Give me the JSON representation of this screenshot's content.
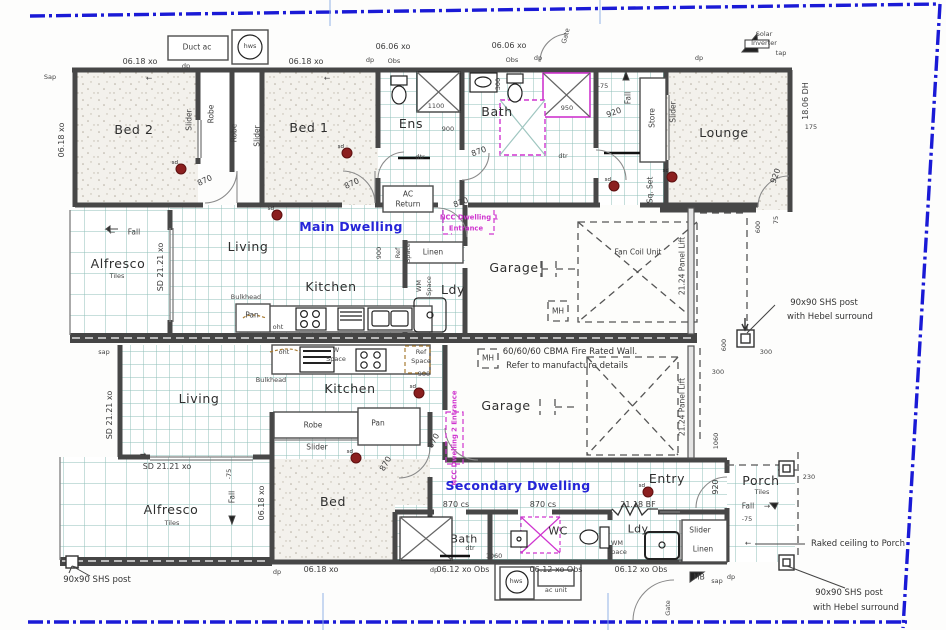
{
  "colors": {
    "boundary_blue": "#1a1ad6",
    "blue_text": "#2525d8",
    "magenta": "#cf35cf",
    "wall": "#474747",
    "tile_line": "#8fbfb8",
    "smoke_detector": "#8b1f1f",
    "hairline_blue": "#93b3e6"
  },
  "smoke_detector_label": "sd",
  "dwellings": {
    "main": "Main Dwelling",
    "secondary": "Secondary Dwelling"
  },
  "fire_wall_note": [
    "60/60/60 CBMA Fire Rated Wall.",
    "Refer to manufacture details"
  ],
  "labels": [
    {
      "n": "duct-ac",
      "t": "Duct ac",
      "x": 197,
      "y": 47,
      "r": 0,
      "c": "s"
    },
    {
      "n": "hws-top",
      "t": "hws",
      "x": 250,
      "y": 46,
      "r": 0,
      "c": "t"
    },
    {
      "n": "dim-0618-a",
      "t": "06.18 xo",
      "x": 140,
      "y": 62,
      "r": 0,
      "c": "d"
    },
    {
      "n": "dp-a",
      "t": "dp",
      "x": 186,
      "y": 66,
      "r": 0,
      "c": "t"
    },
    {
      "n": "dim-0618-b",
      "t": "06.18 xo",
      "x": 306,
      "y": 62,
      "r": 0,
      "c": "d"
    },
    {
      "n": "dim-0606-a",
      "t": "06.06 xo",
      "x": 393,
      "y": 47,
      "r": 0,
      "c": "d"
    },
    {
      "n": "dp-b",
      "t": "dp",
      "x": 370,
      "y": 60,
      "r": 0,
      "c": "t"
    },
    {
      "n": "obs-a",
      "t": "Obs",
      "x": 394,
      "y": 61,
      "r": 0,
      "c": "t"
    },
    {
      "n": "dim-0606-b",
      "t": "06.06 xo",
      "x": 509,
      "y": 46,
      "r": 0,
      "c": "d"
    },
    {
      "n": "obs-b",
      "t": "Obs",
      "x": 512,
      "y": 60,
      "r": 0,
      "c": "t"
    },
    {
      "n": "dp-c",
      "t": "dp",
      "x": 538,
      "y": 58,
      "r": 0,
      "c": "t"
    },
    {
      "n": "gate-top",
      "t": "Gate",
      "x": 566,
      "y": 36,
      "r": -75,
      "c": "t"
    },
    {
      "n": "sap-a",
      "t": "Sap",
      "x": 50,
      "y": 77,
      "r": 0,
      "c": "t"
    },
    {
      "n": "dim-0618-v",
      "t": "06.18 xo",
      "x": 62,
      "y": 140,
      "r": -90,
      "c": "d"
    },
    {
      "n": "room-bed2",
      "t": "Bed 2",
      "x": 134,
      "y": 130,
      "r": 0,
      "c": "r"
    },
    {
      "n": "slider-a",
      "t": "Slider",
      "x": 189,
      "y": 120,
      "r": -90,
      "c": "s"
    },
    {
      "n": "robe-a",
      "t": "Robe",
      "x": 211,
      "y": 114,
      "r": -90,
      "c": "s"
    },
    {
      "n": "robe-b",
      "t": "Robe",
      "x": 234,
      "y": 133,
      "r": -90,
      "c": "s"
    },
    {
      "n": "slider-b",
      "t": "Slider",
      "x": 257,
      "y": 136,
      "r": -90,
      "c": "s"
    },
    {
      "n": "room-bed1",
      "t": "Bed 1",
      "x": 309,
      "y": 128,
      "r": 0,
      "c": "r"
    },
    {
      "n": "door-870-bed2",
      "t": "870",
      "x": 205,
      "y": 181,
      "r": -25,
      "c": "d"
    },
    {
      "n": "door-870-bed1",
      "t": "870",
      "x": 352,
      "y": 184,
      "r": -25,
      "c": "d"
    },
    {
      "n": "room-ens",
      "t": "Ens",
      "x": 411,
      "y": 124,
      "r": 0,
      "c": "r"
    },
    {
      "n": "room-bath",
      "t": "Bath",
      "x": 497,
      "y": 112,
      "r": 0,
      "c": "r"
    },
    {
      "n": "dim-300-basin",
      "t": "300",
      "x": 498,
      "y": 84,
      "r": -90,
      "c": "t"
    },
    {
      "n": "dim-1100",
      "t": "1100",
      "x": 436,
      "y": 106,
      "r": 0,
      "c": "t"
    },
    {
      "n": "dim-900-ens",
      "t": "900",
      "x": 448,
      "y": 129,
      "r": 0,
      "c": "t"
    },
    {
      "n": "dim-950",
      "t": "950",
      "x": 567,
      "y": 108,
      "r": 0,
      "c": "t"
    },
    {
      "n": "door-870-bath",
      "t": "870",
      "x": 479,
      "y": 152,
      "r": -20,
      "c": "d"
    },
    {
      "n": "dtr-a",
      "t": "dtr",
      "x": 420,
      "y": 157,
      "r": 0,
      "c": "t"
    },
    {
      "n": "dtr-b",
      "t": "dtr",
      "x": 563,
      "y": 156,
      "r": 0,
      "c": "t"
    },
    {
      "n": "door-920-hall",
      "t": "920",
      "x": 614,
      "y": 113,
      "r": -20,
      "c": "d"
    },
    {
      "n": "fall-top",
      "t": "Fall",
      "x": 628,
      "y": 98,
      "r": -90,
      "c": "s"
    },
    {
      "n": "dim-75-top",
      "t": "-75",
      "x": 603,
      "y": 86,
      "r": 0,
      "c": "t"
    },
    {
      "n": "store",
      "t": "Store",
      "x": 652,
      "y": 118,
      "r": -90,
      "c": "s"
    },
    {
      "n": "slider-lounge",
      "t": "Slider",
      "x": 673,
      "y": 112,
      "r": -90,
      "c": "s"
    },
    {
      "n": "sq-set",
      "t": "Sq. Set",
      "x": 650,
      "y": 190,
      "r": -90,
      "c": "s"
    },
    {
      "n": "dp-lounge",
      "t": "dp",
      "x": 699,
      "y": 58,
      "r": 0,
      "c": "t"
    },
    {
      "n": "solar-1",
      "t": "Solar",
      "x": 764,
      "y": 34,
      "r": 0,
      "c": "t"
    },
    {
      "n": "solar-2",
      "t": "Inverter",
      "x": 764,
      "y": 43,
      "r": 0,
      "c": "t"
    },
    {
      "n": "tap-a",
      "t": "tap",
      "x": 781,
      "y": 53,
      "r": 0,
      "c": "t"
    },
    {
      "n": "room-lounge",
      "t": "Lounge",
      "x": 724,
      "y": 133,
      "r": 0,
      "c": "r"
    },
    {
      "n": "dim-1806-dh",
      "t": "18.06 DH",
      "x": 806,
      "y": 101,
      "r": -90,
      "c": "d"
    },
    {
      "n": "dim-175",
      "t": "175",
      "x": 811,
      "y": 127,
      "r": 0,
      "c": "t"
    },
    {
      "n": "door-920-lounge",
      "t": "920",
      "x": 776,
      "y": 176,
      "r": -70,
      "c": "d"
    },
    {
      "n": "fall-alf1",
      "t": "Fall",
      "x": 134,
      "y": 232,
      "r": 0,
      "c": "s"
    },
    {
      "n": "arrow-fall1",
      "t": "←",
      "x": 112,
      "y": 232,
      "r": 0,
      "c": "s"
    },
    {
      "n": "room-alfresco1",
      "t": "Alfresco",
      "x": 118,
      "y": 264,
      "r": 0,
      "c": "r"
    },
    {
      "n": "tiles-1",
      "t": "Tiles",
      "x": 117,
      "y": 276,
      "r": 0,
      "c": "t"
    },
    {
      "n": "dim-sd2121-v",
      "t": "SD 21.21 xo",
      "x": 161,
      "y": 267,
      "r": -90,
      "c": "d"
    },
    {
      "n": "room-living1",
      "t": "Living",
      "x": 248,
      "y": 247,
      "r": 0,
      "c": "r"
    },
    {
      "n": "title-main",
      "t": "Main Dwelling",
      "x": 351,
      "y": 227,
      "r": 0,
      "c": "b"
    },
    {
      "n": "room-kitchen1",
      "t": "Kitchen",
      "x": 331,
      "y": 287,
      "r": 0,
      "c": "r"
    },
    {
      "n": "bulkhead-1",
      "t": "Bulkhead",
      "x": 246,
      "y": 297,
      "r": 0,
      "c": "t"
    },
    {
      "n": "pan-1",
      "t": "Pan",
      "x": 252,
      "y": 315,
      "r": 0,
      "c": "s"
    },
    {
      "n": "oht-1",
      "t": "oht",
      "x": 278,
      "y": 327,
      "r": 0,
      "c": "t"
    },
    {
      "n": "ac-return-1",
      "t": "AC",
      "x": 408,
      "y": 194,
      "r": 0,
      "c": "s"
    },
    {
      "n": "ac-return-2",
      "t": "Return",
      "x": 408,
      "y": 204,
      "r": 0,
      "c": "s"
    },
    {
      "n": "door-870-entry1",
      "t": "870",
      "x": 461,
      "y": 203,
      "r": -20,
      "c": "d"
    },
    {
      "n": "ncc1-line1",
      "t": "NCC Dwelling 1",
      "x": 469,
      "y": 218,
      "r": 0,
      "c": "m"
    },
    {
      "n": "ncc1-line2",
      "t": "Entrance",
      "x": 466,
      "y": 229,
      "r": 0,
      "c": "m"
    },
    {
      "n": "dim-900-ref",
      "t": "900",
      "x": 379,
      "y": 253,
      "r": -90,
      "c": "t"
    },
    {
      "n": "ref-1",
      "t": "Ref",
      "x": 398,
      "y": 253,
      "r": -90,
      "c": "t"
    },
    {
      "n": "ref-space-1",
      "t": "Space",
      "x": 408,
      "y": 253,
      "r": -90,
      "c": "t"
    },
    {
      "n": "linen-1",
      "t": "Linen",
      "x": 433,
      "y": 252,
      "r": 0,
      "c": "s"
    },
    {
      "n": "wm-1",
      "t": "WM",
      "x": 419,
      "y": 286,
      "r": -90,
      "c": "t"
    },
    {
      "n": "wm-space-1",
      "t": "Space",
      "x": 429,
      "y": 286,
      "r": -90,
      "c": "t"
    },
    {
      "n": "room-ldy1",
      "t": "Ldy",
      "x": 453,
      "y": 290,
      "r": 0,
      "c": "r"
    },
    {
      "n": "room-garage1",
      "t": "Garage",
      "x": 514,
      "y": 268,
      "r": 0,
      "c": "r"
    },
    {
      "n": "mh-1",
      "t": "MH",
      "x": 558,
      "y": 311,
      "r": 0,
      "c": "s"
    },
    {
      "n": "fan-coil",
      "t": "Fan Coil Unit",
      "x": 638,
      "y": 252,
      "r": 0,
      "c": "s"
    },
    {
      "n": "panel-lift-1",
      "t": "21.24 Panel Lift",
      "x": 682,
      "y": 266,
      "r": -90,
      "c": "s"
    },
    {
      "n": "dim-600-a",
      "t": "600",
      "x": 758,
      "y": 227,
      "r": -90,
      "c": "t"
    },
    {
      "n": "dim-75-b",
      "t": "75",
      "x": 776,
      "y": 220,
      "r": -90,
      "c": "t"
    },
    {
      "n": "shs-1a",
      "t": "90x90 SHS post",
      "x": 824,
      "y": 303,
      "r": 0,
      "c": "n"
    },
    {
      "n": "shs-1b",
      "t": "with Hebel surround",
      "x": 830,
      "y": 317,
      "r": 0,
      "c": "n"
    },
    {
      "n": "dim-600-b",
      "t": "600",
      "x": 724,
      "y": 345,
      "r": -90,
      "c": "t"
    },
    {
      "n": "dim-300-a",
      "t": "300",
      "x": 766,
      "y": 352,
      "r": 0,
      "c": "t"
    },
    {
      "n": "dim-300-b",
      "t": "300",
      "x": 718,
      "y": 372,
      "r": 0,
      "c": "t"
    },
    {
      "n": "sap-b",
      "t": "sap",
      "x": 104,
      "y": 352,
      "r": 0,
      "c": "t"
    },
    {
      "n": "firewall-1",
      "t": "60/60/60 CBMA Fire Rated Wall.",
      "x": 570,
      "y": 352,
      "r": 0,
      "c": "n"
    },
    {
      "n": "firewall-2",
      "t": "Refer to manufacture details",
      "x": 567,
      "y": 366,
      "r": 0,
      "c": "n"
    },
    {
      "n": "ref-2",
      "t": "Ref",
      "x": 421,
      "y": 352,
      "r": 0,
      "c": "t"
    },
    {
      "n": "ref-space-2",
      "t": "Space",
      "x": 421,
      "y": 361,
      "r": 0,
      "c": "t"
    },
    {
      "n": "dim-900-ref2",
      "t": "900",
      "x": 424,
      "y": 374,
      "r": 0,
      "c": "t"
    },
    {
      "n": "oht-2",
      "t": "oht",
      "x": 284,
      "y": 352,
      "r": 0,
      "c": "t"
    },
    {
      "n": "w-2",
      "t": "W",
      "x": 336,
      "y": 350,
      "r": 0,
      "c": "t"
    },
    {
      "n": "w-space-2",
      "t": "Space",
      "x": 336,
      "y": 359,
      "r": 0,
      "c": "t"
    },
    {
      "n": "bulkhead-2",
      "t": "Bulkhead",
      "x": 271,
      "y": 380,
      "r": 0,
      "c": "t"
    },
    {
      "n": "room-living2",
      "t": "Living",
      "x": 199,
      "y": 399,
      "r": 0,
      "c": "r"
    },
    {
      "n": "room-kitchen2",
      "t": "Kitchen",
      "x": 350,
      "y": 389,
      "r": 0,
      "c": "r"
    },
    {
      "n": "dim-sd2121-v2",
      "t": "SD 21.21 xo",
      "x": 110,
      "y": 415,
      "r": -90,
      "c": "d"
    },
    {
      "n": "dim-sd2121-h",
      "t": "SD 21.21 xo",
      "x": 167,
      "y": 467,
      "r": 0,
      "c": "d"
    },
    {
      "n": "arrow-right-1",
      "t": "→",
      "x": 143,
      "y": 454,
      "r": 0,
      "c": "s"
    },
    {
      "n": "fall-2",
      "t": "Fall",
      "x": 232,
      "y": 497,
      "r": -90,
      "c": "s"
    },
    {
      "n": "dim-75-c",
      "t": "-75",
      "x": 229,
      "y": 474,
      "r": -90,
      "c": "t"
    },
    {
      "n": "dim-0618-v2",
      "t": "06.18 xo",
      "x": 262,
      "y": 503,
      "r": -90,
      "c": "d"
    },
    {
      "n": "room-alfresco2",
      "t": "Alfresco",
      "x": 171,
      "y": 510,
      "r": 0,
      "c": "r"
    },
    {
      "n": "tiles-2",
      "t": "Tiles",
      "x": 172,
      "y": 523,
      "r": 0,
      "c": "t"
    },
    {
      "n": "robe-2",
      "t": "Robe",
      "x": 313,
      "y": 425,
      "r": 0,
      "c": "s"
    },
    {
      "n": "slider-2",
      "t": "Slider",
      "x": 317,
      "y": 447,
      "r": 0,
      "c": "s"
    },
    {
      "n": "pan-2",
      "t": "Pan",
      "x": 378,
      "y": 423,
      "r": 0,
      "c": "s"
    },
    {
      "n": "door-870-bed3",
      "t": "870",
      "x": 386,
      "y": 464,
      "r": -60,
      "c": "d"
    },
    {
      "n": "room-bed3",
      "t": "Bed",
      "x": 333,
      "y": 502,
      "r": 0,
      "c": "r"
    },
    {
      "n": "ncc2",
      "t": "NCC Dwelling 2 Entrance",
      "x": 455,
      "y": 438,
      "r": -90,
      "c": "m"
    },
    {
      "n": "door-870-gar2",
      "t": "870",
      "x": 434,
      "y": 441,
      "r": -60,
      "c": "d"
    },
    {
      "n": "room-garage2",
      "t": "Garage",
      "x": 506,
      "y": 406,
      "r": 0,
      "c": "r"
    },
    {
      "n": "mh-2",
      "t": "MH",
      "x": 488,
      "y": 358,
      "r": 0,
      "c": "s"
    },
    {
      "n": "panel-lift-2",
      "t": "21.24 Panel Lift",
      "x": 682,
      "y": 407,
      "r": -90,
      "c": "s"
    },
    {
      "n": "title-secondary",
      "t": "Secondary Dwelling",
      "x": 518,
      "y": 486,
      "r": 0,
      "c": "b"
    },
    {
      "n": "door-870cs-a",
      "t": "870 cs",
      "x": 456,
      "y": 505,
      "r": 0,
      "c": "d"
    },
    {
      "n": "door-870cs-b",
      "t": "870 cs",
      "x": 543,
      "y": 505,
      "r": 0,
      "c": "d"
    },
    {
      "n": "win-2118bf",
      "t": "21.18 BF",
      "x": 638,
      "y": 505,
      "r": 0,
      "c": "d"
    },
    {
      "n": "room-entry",
      "t": "Entry",
      "x": 667,
      "y": 479,
      "r": 0,
      "c": "r"
    },
    {
      "n": "door-920-entry",
      "t": "920",
      "x": 716,
      "y": 487,
      "r": -90,
      "c": "d"
    },
    {
      "n": "room-porch",
      "t": "Porch",
      "x": 761,
      "y": 481,
      "r": 0,
      "c": "r"
    },
    {
      "n": "tiles-3",
      "t": "Tiles",
      "x": 762,
      "y": 492,
      "r": 0,
      "c": "t"
    },
    {
      "n": "fall-3",
      "t": "Fall",
      "x": 748,
      "y": 506,
      "r": 0,
      "c": "s"
    },
    {
      "n": "arrow-fall3",
      "t": "→",
      "x": 767,
      "y": 506,
      "r": 0,
      "c": "s"
    },
    {
      "n": "dim-75-d",
      "t": "-75",
      "x": 747,
      "y": 519,
      "r": 0,
      "c": "t"
    },
    {
      "n": "dim-230",
      "t": "230",
      "x": 809,
      "y": 477,
      "r": 0,
      "c": "t"
    },
    {
      "n": "raked-note",
      "t": "Raked ceiling to Porch",
      "x": 858,
      "y": 544,
      "r": 0,
      "c": "n"
    },
    {
      "n": "arrow-raked",
      "t": "←",
      "x": 748,
      "y": 543,
      "r": 0,
      "c": "s"
    },
    {
      "n": "room-bath2",
      "t": "Bath",
      "x": 464,
      "y": 539,
      "r": 0,
      "c": "r2"
    },
    {
      "n": "room-wc2",
      "t": "WC",
      "x": 558,
      "y": 531,
      "r": 0,
      "c": "r2"
    },
    {
      "n": "room-ldy2",
      "t": "Ldy",
      "x": 638,
      "y": 529,
      "r": 0,
      "c": "r2"
    },
    {
      "n": "dtr-c",
      "t": "dtr",
      "x": 470,
      "y": 548,
      "r": 0,
      "c": "t"
    },
    {
      "n": "dim-1060",
      "t": "1060",
      "x": 494,
      "y": 556,
      "r": 0,
      "c": "t"
    },
    {
      "n": "wm-2",
      "t": "WM",
      "x": 617,
      "y": 543,
      "r": 0,
      "c": "t"
    },
    {
      "n": "wm-space-2",
      "t": "Space",
      "x": 617,
      "y": 552,
      "r": 0,
      "c": "t"
    },
    {
      "n": "slider-3",
      "t": "Slider",
      "x": 700,
      "y": 530,
      "r": 0,
      "c": "s"
    },
    {
      "n": "linen-2",
      "t": "Linen",
      "x": 703,
      "y": 549,
      "r": 0,
      "c": "s"
    },
    {
      "n": "mb-2",
      "t": "MB",
      "x": 699,
      "y": 577,
      "r": 0,
      "c": "s"
    },
    {
      "n": "sap-c",
      "t": "sap",
      "x": 717,
      "y": 581,
      "r": 0,
      "c": "t"
    },
    {
      "n": "dp-d",
      "t": "dp",
      "x": 731,
      "y": 577,
      "r": 0,
      "c": "t"
    },
    {
      "n": "dim-1060-b",
      "t": "1060",
      "x": 716,
      "y": 441,
      "r": -90,
      "c": "t"
    },
    {
      "n": "dp-e",
      "t": "dp",
      "x": 434,
      "y": 570,
      "r": 0,
      "c": "t"
    },
    {
      "n": "dim-0612-a",
      "t": "06.12 xo Obs",
      "x": 463,
      "y": 570,
      "r": 0,
      "c": "d"
    },
    {
      "n": "dim-0612-b",
      "t": "06.12 xo Obs",
      "x": 556,
      "y": 570,
      "r": 0,
      "c": "d"
    },
    {
      "n": "dim-0612-c",
      "t": "06.12 xo Obs",
      "x": 641,
      "y": 570,
      "r": 0,
      "c": "d"
    },
    {
      "n": "hws-bottom",
      "t": "hws",
      "x": 516,
      "y": 581,
      "r": 0,
      "c": "t"
    },
    {
      "n": "ac-unit",
      "t": "ac unit",
      "x": 556,
      "y": 590,
      "r": 0,
      "c": "t"
    },
    {
      "n": "gate-bottom",
      "t": "Gate",
      "x": 668,
      "y": 608,
      "r": -90,
      "c": "t"
    },
    {
      "n": "dp-f",
      "t": "dp",
      "x": 277,
      "y": 572,
      "r": 0,
      "c": "t"
    },
    {
      "n": "dim-0618-c",
      "t": "06.18 xo",
      "x": 321,
      "y": 570,
      "r": 0,
      "c": "d"
    },
    {
      "n": "shs-2",
      "t": "90x90 SHS post",
      "x": 97,
      "y": 580,
      "r": 0,
      "c": "n"
    },
    {
      "n": "shs-3a",
      "t": "90x90 SHS post",
      "x": 849,
      "y": 593,
      "r": 0,
      "c": "n"
    },
    {
      "n": "shs-3b",
      "t": "with Hebel surround",
      "x": 856,
      "y": 608,
      "r": 0,
      "c": "n"
    },
    {
      "n": "arrow-win-a",
      "t": "←",
      "x": 149,
      "y": 78,
      "r": 0,
      "c": "s"
    },
    {
      "n": "arrow-win-b",
      "t": "←",
      "x": 327,
      "y": 78,
      "r": 0,
      "c": "s"
    }
  ],
  "smoke_detectors": [
    {
      "x": 181,
      "y": 169
    },
    {
      "x": 277,
      "y": 215
    },
    {
      "x": 347,
      "y": 153
    },
    {
      "x": 614,
      "y": 186
    },
    {
      "x": 672,
      "y": 177
    },
    {
      "x": 419,
      "y": 393
    },
    {
      "x": 356,
      "y": 458
    },
    {
      "x": 648,
      "y": 492
    }
  ]
}
